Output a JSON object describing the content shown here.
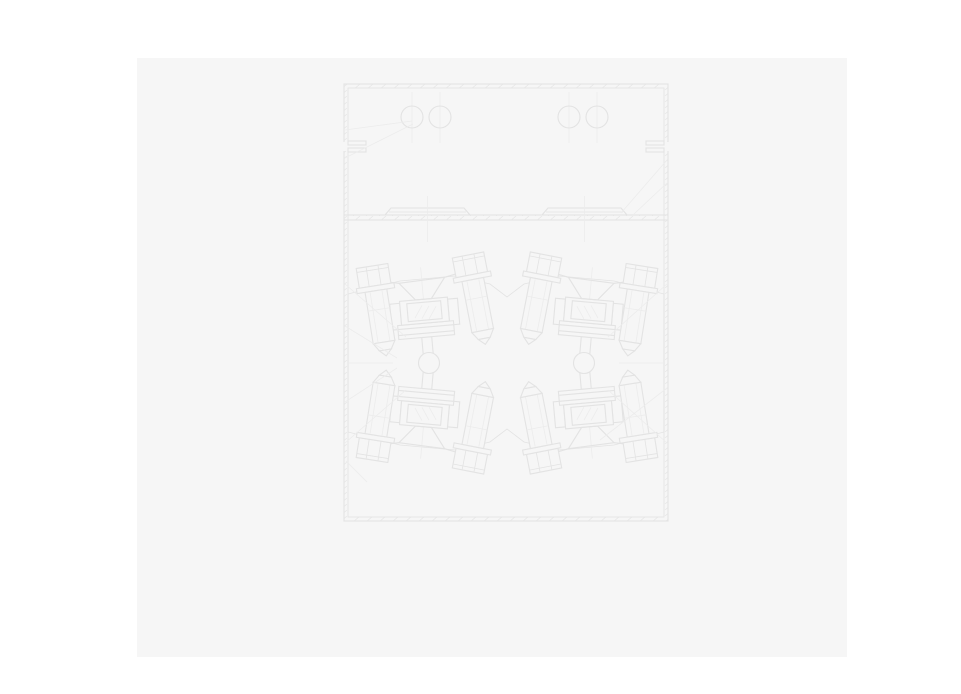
{
  "colors": {
    "page_bg": "#ffffff",
    "panel_bg": "#f6f6f6",
    "line_main": "#e3e3e3",
    "line_light": "#ececec"
  },
  "drawing": {
    "type": "engineering-cross-section",
    "style": "faint-cad-line-drawing",
    "components": [
      "enclosure-frame",
      "top-chamber",
      "chamber-circles",
      "wall-notches",
      "gasket-divider",
      "gasket-plates",
      "hatched-body",
      "sight-glass-assemblies",
      "clamp-bolts",
      "pivot-circles",
      "leader-lines"
    ],
    "chamber_circle_count": 4,
    "bolt_count": 8,
    "assembly_count": 4,
    "pivot_circle_count": 2
  }
}
